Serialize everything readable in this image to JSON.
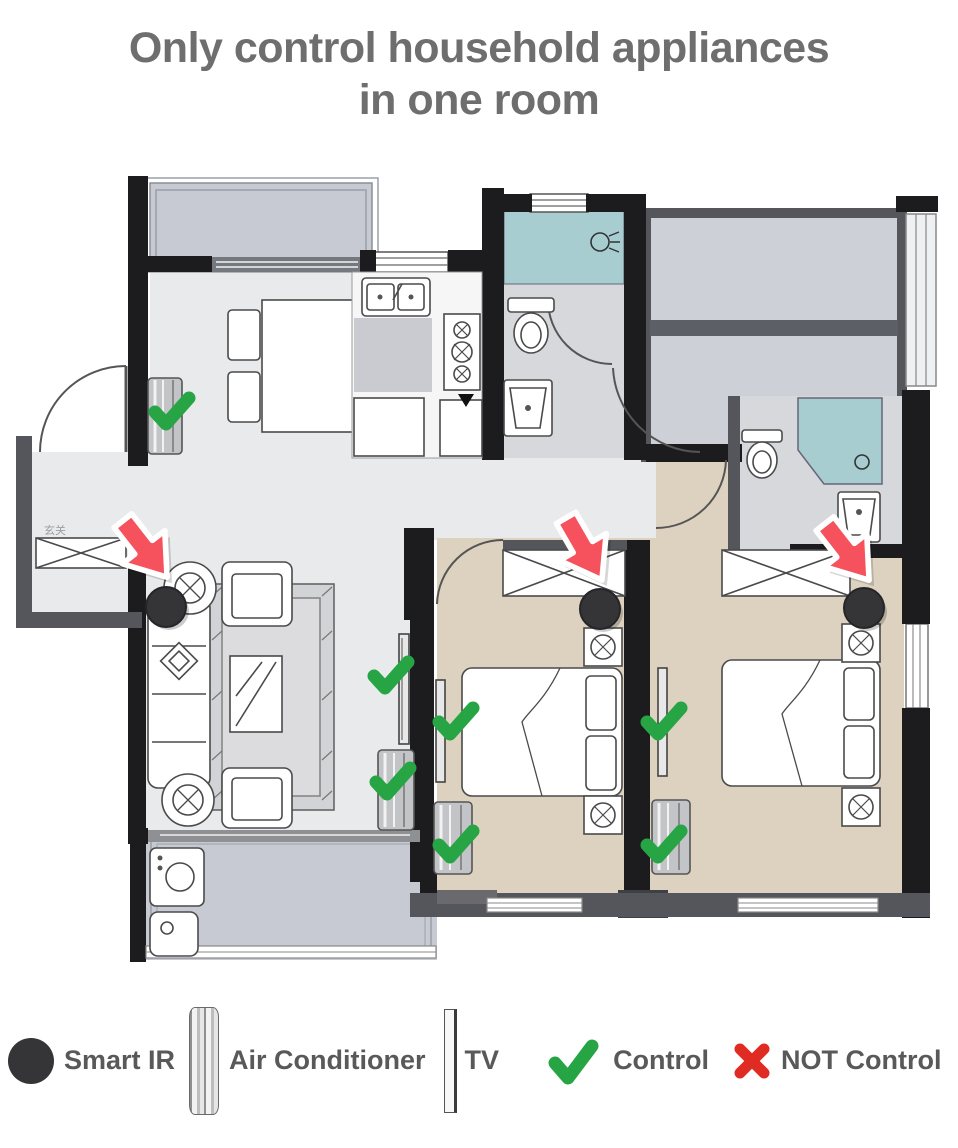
{
  "title": {
    "line1": "Only control household appliances",
    "line2": "in one room"
  },
  "colors": {
    "title_gray": "#6e6e6e",
    "legend_text": "#595959",
    "check_green": "#27a544",
    "cross_red": "#e02b22",
    "arrow_red": "#f5525e",
    "smart_ir_black": "#353537",
    "wall_black": "#1c1c1e",
    "wall_gray": "#54565c",
    "bedroom_beige": "#ddd2c0",
    "bathroom_teal": "#a8cdd1",
    "balcony_gray": "#c7cad2",
    "floor_gray": "#e9eaec"
  },
  "floorplan": {
    "entrance_label": "玄关",
    "markers": {
      "arrows": [
        {
          "points_to": "living-room-smart-ir",
          "x": 145,
          "y": 549,
          "rotate": -38
        },
        {
          "points_to": "middle-bedroom-smart-ir",
          "x": 584,
          "y": 549,
          "rotate": -30
        },
        {
          "points_to": "right-bedroom-smart-ir",
          "x": 847,
          "y": 552,
          "rotate": -38
        }
      ],
      "smart_ir": [
        {
          "room": "living-room",
          "x": 166,
          "y": 607
        },
        {
          "room": "middle-bedroom",
          "x": 600,
          "y": 609
        },
        {
          "room": "right-bedroom",
          "x": 864,
          "y": 608
        }
      ],
      "checks": [
        {
          "target": "dining-air-conditioner",
          "x": 171,
          "y": 412
        },
        {
          "target": "living-room-tv",
          "x": 390,
          "y": 676
        },
        {
          "target": "middle-bedroom-tv",
          "x": 455,
          "y": 722
        },
        {
          "target": "living-room-air-conditioner",
          "x": 392,
          "y": 782
        },
        {
          "target": "middle-bedroom-air-conditioner",
          "x": 455,
          "y": 845
        },
        {
          "target": "right-bedroom-tv",
          "x": 663,
          "y": 722
        },
        {
          "target": "right-bedroom-air-conditioner",
          "x": 663,
          "y": 845
        }
      ]
    }
  },
  "legend": {
    "items": [
      {
        "icon": "smart-ir-icon",
        "label": "Smart IR"
      },
      {
        "icon": "air-conditioner-icon",
        "label": "Air Conditioner"
      },
      {
        "icon": "tv-icon",
        "label": "TV"
      },
      {
        "icon": "check-icon",
        "label": "Control"
      },
      {
        "icon": "cross-icon",
        "label": "NOT Control"
      }
    ]
  }
}
